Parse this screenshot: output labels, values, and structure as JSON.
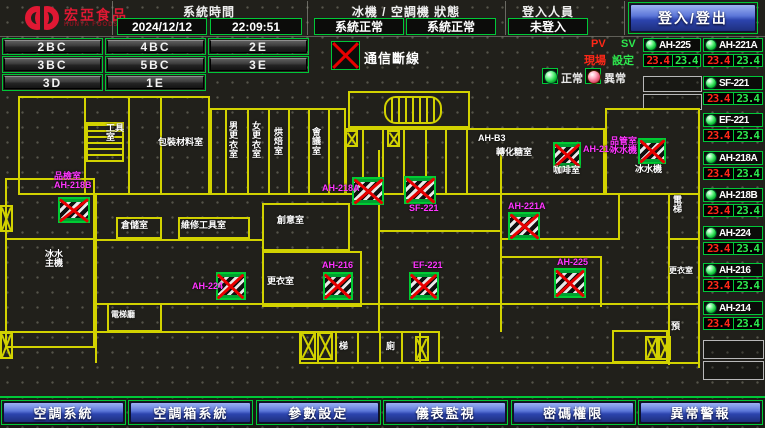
{
  "header": {
    "brand": {
      "name": "宏亞食品",
      "sub": "HUNYA FOODS"
    },
    "time": {
      "label": "系統時間",
      "date": "2024/12/12",
      "clock": "22:09:51"
    },
    "status": {
      "label": "冰機 / 空調機 狀態",
      "chiller": "系統正常",
      "ahu": "系統正常"
    },
    "login": {
      "label": "登入人員",
      "user": "未登入",
      "button": "登入/登出"
    }
  },
  "zone_buttons": [
    "2BC",
    "4BC",
    "2E",
    "3BC",
    "5BC",
    "3E",
    "3D",
    "1E"
  ],
  "legend": {
    "comm_fail": "通信斷線",
    "pv": "PV",
    "sv": "SV",
    "pv_name": "現場",
    "sv_name": "設定",
    "normal": "正常",
    "abnormal": "異常"
  },
  "panel": {
    "left": [
      {
        "name": "AH-225",
        "pv": "23.4",
        "sv": "23.4"
      }
    ],
    "right": [
      {
        "name": "AH-221A",
        "pv": "23.4",
        "sv": "23.4"
      },
      {
        "name": "SF-221",
        "pv": "23.4",
        "sv": "23.4"
      },
      {
        "name": "EF-221",
        "pv": "23.4",
        "sv": "23.4"
      },
      {
        "name": "AH-218A",
        "pv": "23.4",
        "sv": "23.4"
      },
      {
        "name": "AH-218B",
        "pv": "23.4",
        "sv": "23.4"
      },
      {
        "name": "AH-224",
        "pv": "23.4",
        "sv": "23.4"
      },
      {
        "name": "AH-216",
        "pv": "23.4",
        "sv": "23.4"
      },
      {
        "name": "AH-214",
        "pv": "23.4",
        "sv": "23.4"
      }
    ]
  },
  "map": {
    "labels": [
      {
        "t": "工具\n室",
        "x": 106,
        "y": 34,
        "c": "w"
      },
      {
        "t": "包裝材料室",
        "x": 158,
        "y": 48,
        "c": "w"
      },
      {
        "t": "男\n更\n衣\n室",
        "x": 229,
        "y": 32,
        "c": "w"
      },
      {
        "t": "女\n更\n衣\n室",
        "x": 252,
        "y": 32,
        "c": "w"
      },
      {
        "t": "烘\n焙\n室",
        "x": 274,
        "y": 38,
        "c": "w"
      },
      {
        "t": "會\n議\n室",
        "x": 312,
        "y": 38,
        "c": "w"
      },
      {
        "t": "AH-B3",
        "x": 478,
        "y": 44,
        "c": "w"
      },
      {
        "t": "轉化糖室",
        "x": 496,
        "y": 58,
        "c": "w"
      },
      {
        "t": "咖啡室",
        "x": 553,
        "y": 76,
        "c": "w"
      },
      {
        "t": "冰水機",
        "x": 635,
        "y": 75,
        "c": "w"
      },
      {
        "t": "倉儲室",
        "x": 121,
        "y": 131,
        "c": "w"
      },
      {
        "t": "維修工具室",
        "x": 181,
        "y": 131,
        "c": "w"
      },
      {
        "t": "創意室",
        "x": 277,
        "y": 126,
        "c": "w"
      },
      {
        "t": "更衣室",
        "x": 267,
        "y": 187,
        "c": "w"
      },
      {
        "t": "冰水\n主機",
        "x": 45,
        "y": 160,
        "c": "w"
      },
      {
        "t": "電\n梯",
        "x": 673,
        "y": 106,
        "c": "w"
      },
      {
        "t": "更衣室",
        "x": 669,
        "y": 177,
        "c": "w",
        "s": 8
      },
      {
        "t": "預",
        "x": 671,
        "y": 232,
        "c": "w"
      },
      {
        "t": "梯",
        "x": 339,
        "y": 252,
        "c": "w"
      },
      {
        "t": "廁",
        "x": 386,
        "y": 252,
        "c": "w"
      },
      {
        "t": "電梯廳",
        "x": 111,
        "y": 221,
        "c": "w",
        "s": 8
      },
      {
        "t": "品檢室\nAH-218B",
        "x": 54,
        "y": 82,
        "c": "m"
      },
      {
        "t": "AH-218A",
        "x": 322,
        "y": 94,
        "c": "m"
      },
      {
        "t": "SF-221",
        "x": 409,
        "y": 114,
        "c": "m"
      },
      {
        "t": "AH-216",
        "x": 322,
        "y": 171,
        "c": "m"
      },
      {
        "t": "EF-221",
        "x": 413,
        "y": 171,
        "c": "m"
      },
      {
        "t": "AH-221A",
        "x": 508,
        "y": 112,
        "c": "m"
      },
      {
        "t": "AH-225",
        "x": 557,
        "y": 168,
        "c": "m"
      },
      {
        "t": "AH-224",
        "x": 192,
        "y": 192,
        "c": "m"
      },
      {
        "t": "AH-214",
        "x": 583,
        "y": 55,
        "c": "m"
      },
      {
        "t": "品管室\n冰水機",
        "x": 610,
        "y": 47,
        "c": "m"
      }
    ],
    "fail_icons": [
      {
        "x": 58,
        "y": 107,
        "w": 32,
        "h": 26
      },
      {
        "x": 216,
        "y": 182,
        "w": 30,
        "h": 28
      },
      {
        "x": 323,
        "y": 182,
        "w": 30,
        "h": 28
      },
      {
        "x": 409,
        "y": 182,
        "w": 30,
        "h": 28
      },
      {
        "x": 352,
        "y": 87,
        "w": 32,
        "h": 28
      },
      {
        "x": 404,
        "y": 86,
        "w": 32,
        "h": 28
      },
      {
        "x": 508,
        "y": 122,
        "w": 32,
        "h": 28
      },
      {
        "x": 554,
        "y": 178,
        "w": 32,
        "h": 30
      },
      {
        "x": 553,
        "y": 52,
        "w": 28,
        "h": 26
      },
      {
        "x": 638,
        "y": 48,
        "w": 28,
        "h": 26
      }
    ],
    "x_boxes": [
      {
        "x": 345,
        "y": 40,
        "w": 13,
        "h": 17
      },
      {
        "x": 387,
        "y": 40,
        "w": 13,
        "h": 17
      },
      {
        "x": 300,
        "y": 242,
        "w": 16,
        "h": 28
      },
      {
        "x": 317,
        "y": 242,
        "w": 16,
        "h": 28
      },
      {
        "x": 415,
        "y": 246,
        "w": 14,
        "h": 25
      },
      {
        "x": 645,
        "y": 246,
        "w": 13,
        "h": 24
      },
      {
        "x": 658,
        "y": 246,
        "w": 13,
        "h": 24
      },
      {
        "x": 0,
        "y": 242,
        "w": 13,
        "h": 27
      },
      {
        "x": 0,
        "y": 115,
        "w": 13,
        "h": 27
      }
    ]
  },
  "nav": [
    "空調系統",
    "空調箱系統",
    "參數設定",
    "儀表監視",
    "密碼權限",
    "異常警報"
  ]
}
